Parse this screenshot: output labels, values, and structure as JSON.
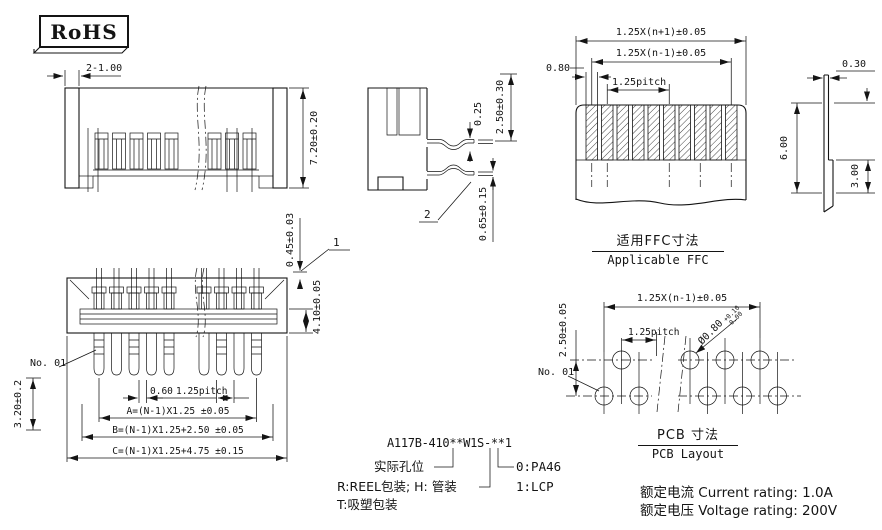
{
  "app": {
    "background": "#ffffff",
    "ink": "#141414"
  },
  "rohs": {
    "label": "RoHS"
  },
  "front_view": {
    "dim_wall": "2-1.00",
    "dim_height": "7.20±0.20"
  },
  "side_view": {
    "dim_gap": "0.25",
    "dim_height": "2.50±0.30",
    "dim_pin": "0.65±0.15",
    "callout": "2"
  },
  "ffc": {
    "dim_overall": "1.25X(n+1)±0.05",
    "dim_span": "1.25X(n-1)±0.05",
    "dim_conductor": "0.80",
    "dim_pitch": "1.25pitch",
    "dim_thickness": "0.30",
    "dim_length": "6.00",
    "dim_exposed": "3.00",
    "caption_zh": "适用FFC寸法",
    "caption_en": "Applicable FFC"
  },
  "bottom_view": {
    "callout": "1",
    "dim_tab": "0.45±0.03",
    "dim_depth": "4.10±0.05",
    "pin_label": "No. 01",
    "dim_tail": "3.20±0.2",
    "dim_slot": "0.60",
    "dim_pitch": "1.25pitch",
    "dim_a": "A=(N-1)X1.25 ±0.05",
    "dim_b": "B=(N-1)X1.25+2.50 ±0.05",
    "dim_c": "C=(N-1)X1.25+4.75 ±0.15"
  },
  "pcb": {
    "dim_span": "1.25X(n-1)±0.05",
    "dim_rows": "2.50±0.05",
    "dim_pitch": "1.25pitch",
    "dim_hole": "Ø0.80",
    "dim_hole_tol_upper": "+0.10",
    "dim_hole_tol_lower": "-0.00",
    "pin_label": "No. 01",
    "caption_zh": "PCB  寸法",
    "caption_en": "PCB Layout"
  },
  "part_number": {
    "code": "A117B-410**W1S-**1",
    "legend_hole": "实际孔位",
    "legend_pack_a": "R:REEL包装; H: 管装",
    "legend_pack_b": "T:吸塑包装",
    "material_0": "0:PA46",
    "material_1": "1:LCP"
  },
  "ratings": {
    "current": "额定电流 Current rating: 1.0A",
    "voltage": "额定电压 Voltage rating: 200V"
  }
}
